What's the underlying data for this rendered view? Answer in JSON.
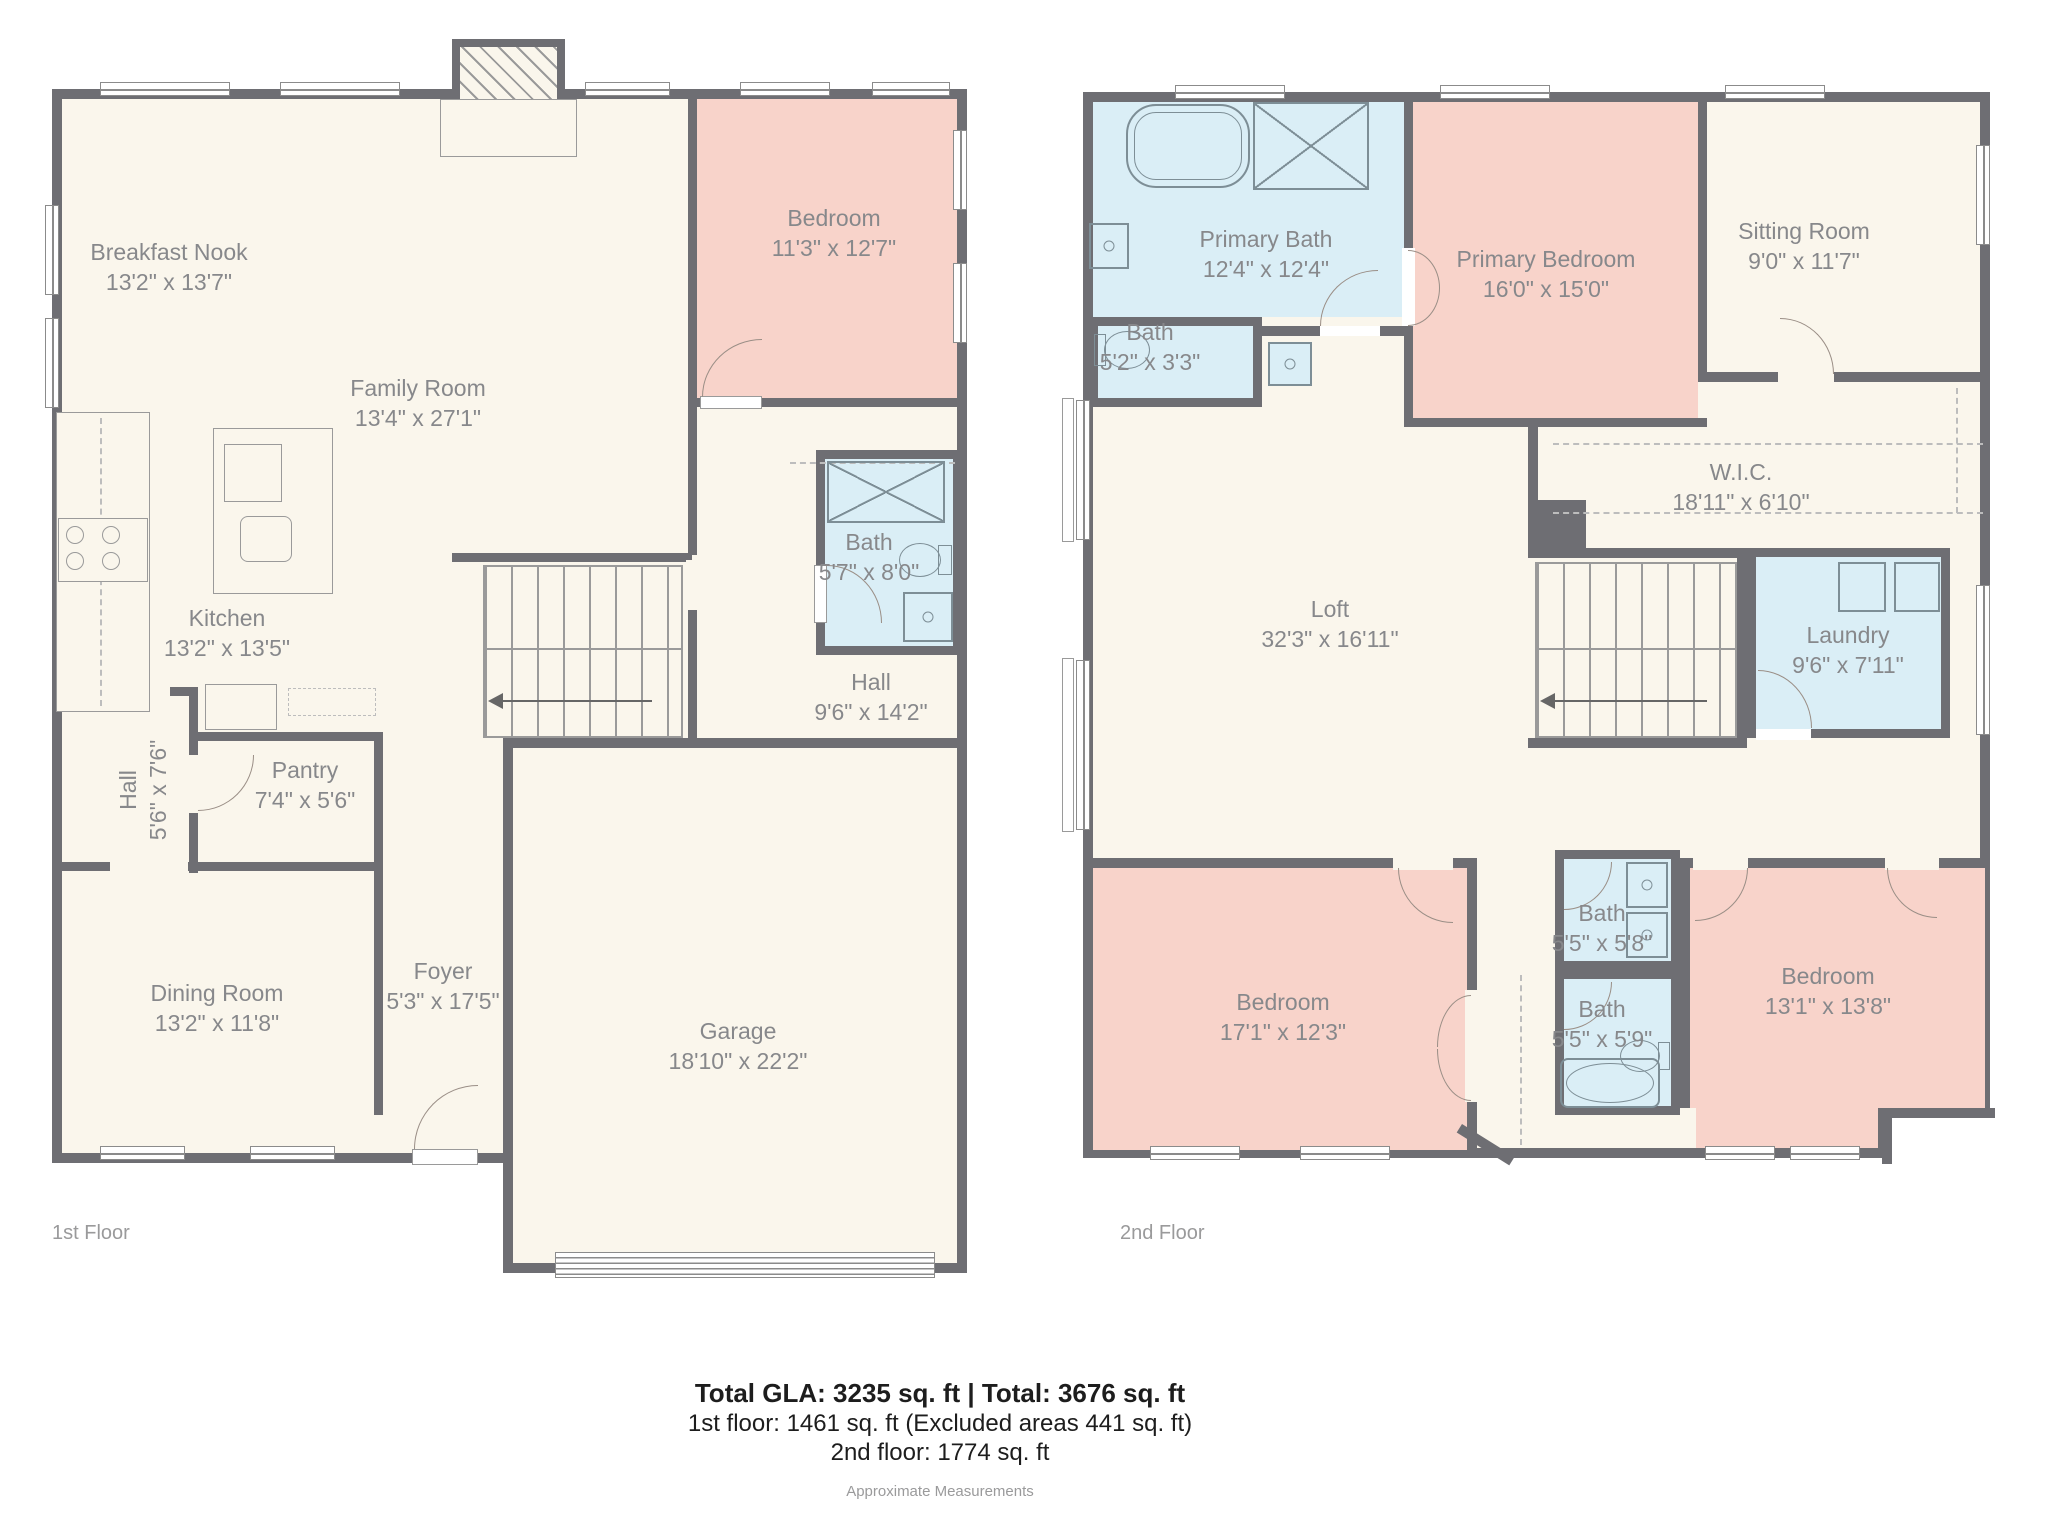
{
  "title": "Floor plan",
  "colors": {
    "wall": "#6E6E73",
    "floor": "#FAF6EC",
    "bedroom_fill": "#F8D3CA",
    "bath_fill": "#DAEEF6",
    "room_label": "#87888B",
    "summary_text": "#1D1D1D",
    "muted_text": "#9A9A9B"
  },
  "floor1": {
    "label": "1st Floor",
    "rooms": [
      {
        "name": "Breakfast Nook",
        "dims": "13'2\" x 13'7\""
      },
      {
        "name": "Family Room",
        "dims": "13'4\" x 27'1\""
      },
      {
        "name": "Bedroom",
        "dims": "11'3\" x 12'7\""
      },
      {
        "name": "Kitchen",
        "dims": "13'2\" x 13'5\""
      },
      {
        "name": "Bath",
        "dims": "5'7\" x 8'0\""
      },
      {
        "name": "Hall",
        "dims": "9'6\" x 14'2\""
      },
      {
        "name": "Hall",
        "dims": "5'6\" x 7'6\""
      },
      {
        "name": "Pantry",
        "dims": "7'4\" x 5'6\""
      },
      {
        "name": "Dining Room",
        "dims": "13'2\" x 11'8\""
      },
      {
        "name": "Foyer",
        "dims": "5'3\" x 17'5\""
      },
      {
        "name": "Garage",
        "dims": "18'10\" x 22'2\""
      }
    ]
  },
  "floor2": {
    "label": "2nd Floor",
    "rooms": [
      {
        "name": "Primary Bath",
        "dims": "12'4\" x 12'4\""
      },
      {
        "name": "Bath",
        "dims": "5'2\" x 3'3\""
      },
      {
        "name": "Primary Bedroom",
        "dims": "16'0\" x 15'0\""
      },
      {
        "name": "Sitting Room",
        "dims": "9'0\" x 11'7\""
      },
      {
        "name": "W.I.C.",
        "dims": "18'11\" x 6'10\""
      },
      {
        "name": "Loft",
        "dims": "32'3\" x 16'11\""
      },
      {
        "name": "Laundry",
        "dims": "9'6\" x 7'11\""
      },
      {
        "name": "Bedroom",
        "dims": "17'1\" x 12'3\""
      },
      {
        "name": "Bath",
        "dims": "5'5\" x 5'8\""
      },
      {
        "name": "Bath",
        "dims": "5'5\" x 5'9\""
      },
      {
        "name": "Bedroom",
        "dims": "13'1\" x 13'8\""
      }
    ]
  },
  "summary": {
    "line1": "Total GLA: 3235 sq. ft | Total: 3676 sq. ft",
    "line2": "1st floor: 1461 sq. ft (Excluded areas 441 sq. ft)",
    "line3": "2nd floor: 1774 sq. ft",
    "footnote": "Approximate Measurements"
  }
}
